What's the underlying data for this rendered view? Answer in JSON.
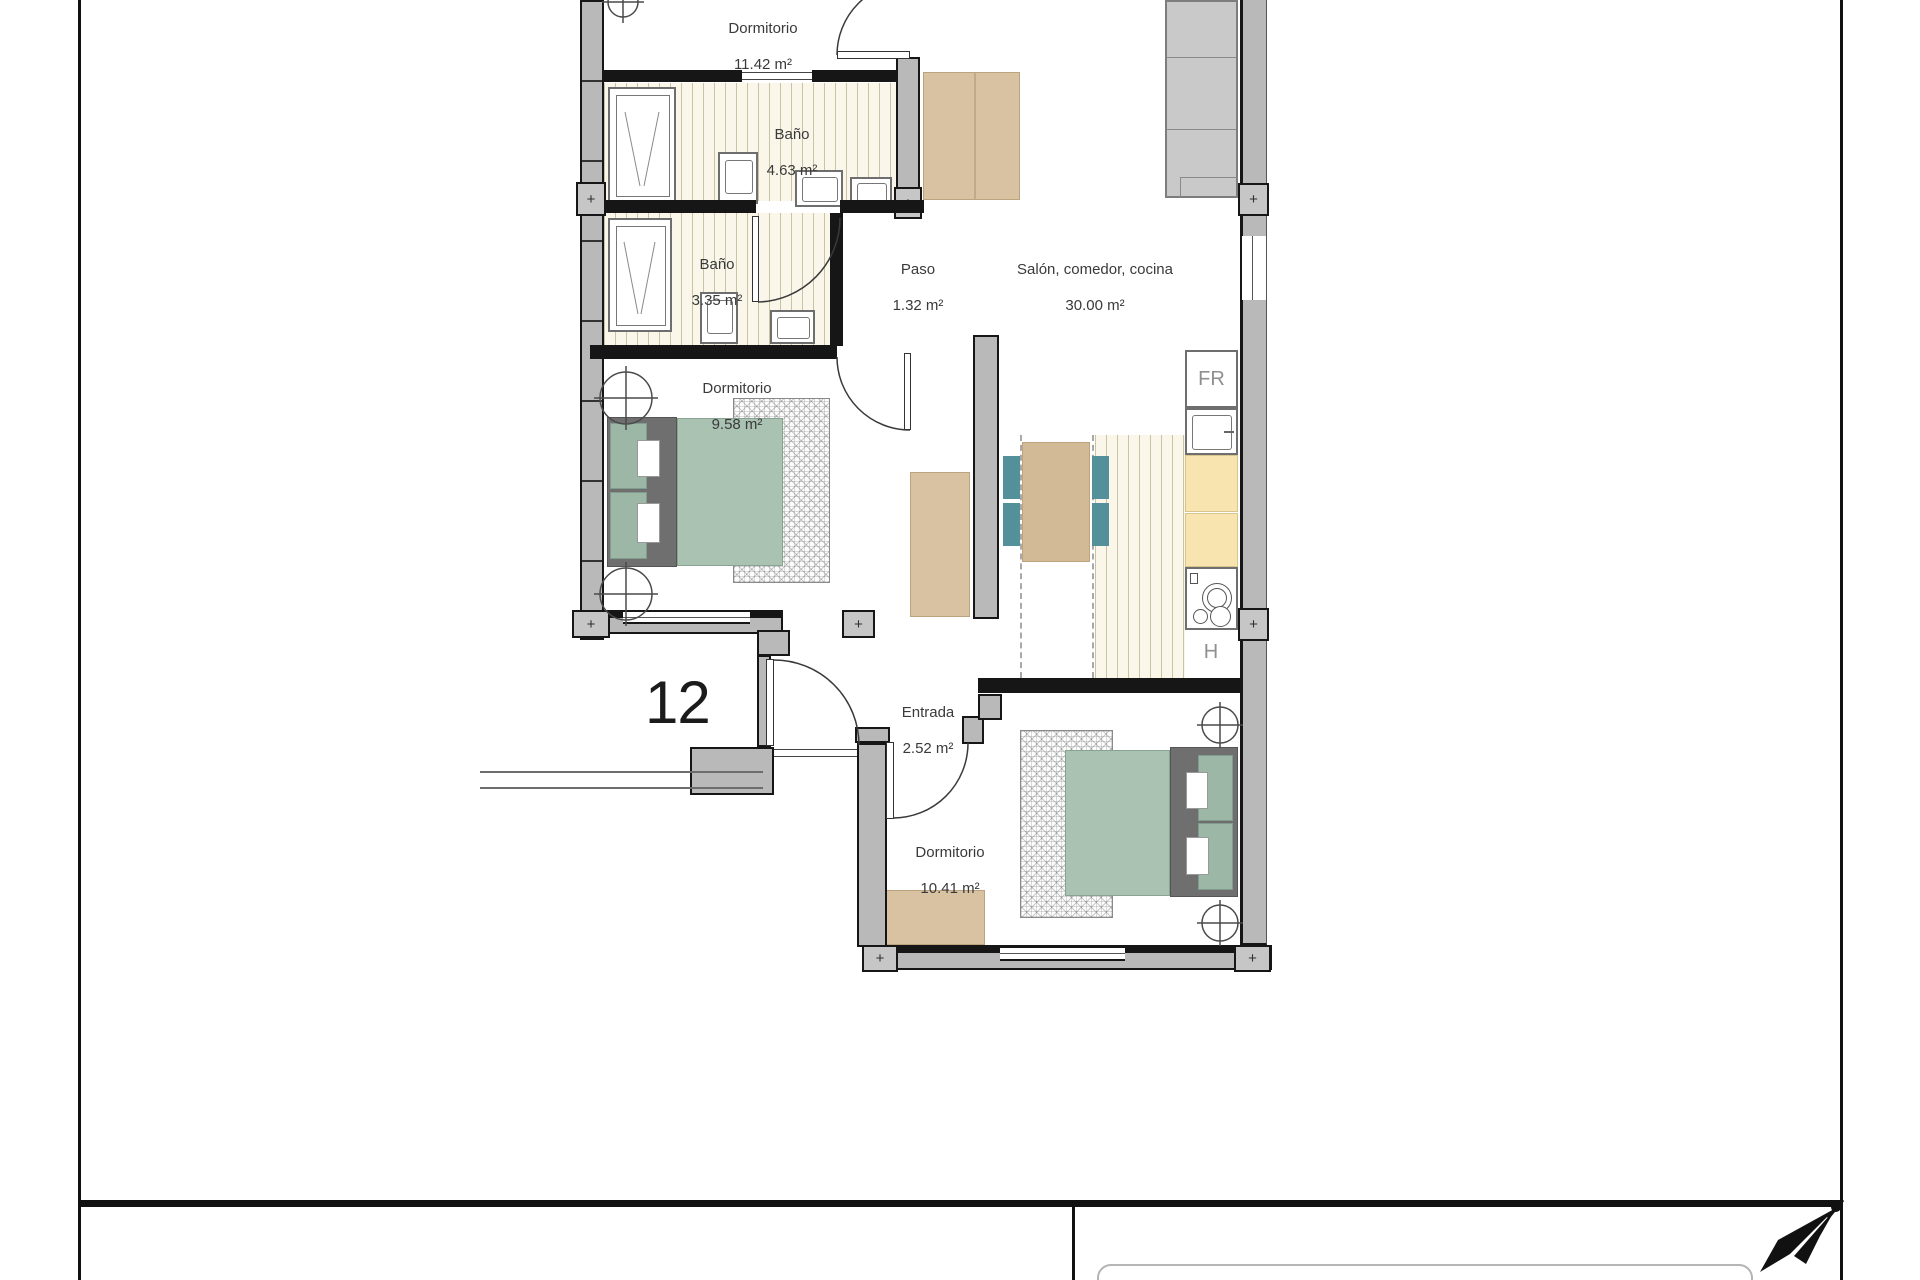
{
  "plan": {
    "unit_number": "12",
    "rooms": [
      {
        "id": "dormitorio-1",
        "name": "Dormitorio",
        "area": "11.42 m²"
      },
      {
        "id": "bano-1",
        "name": "Baño",
        "area": "4.63 m²"
      },
      {
        "id": "bano-2",
        "name": "Baño",
        "area": "3.35 m²"
      },
      {
        "id": "paso",
        "name": "Paso",
        "area": "1.32 m²"
      },
      {
        "id": "salon-comedor-cocina",
        "name": "Salón, comedor, cocina",
        "area": "30.00 m²"
      },
      {
        "id": "dormitorio-2",
        "name": "Dormitorio",
        "area": "9.58 m²"
      },
      {
        "id": "entrada",
        "name": "Entrada",
        "area": "2.52 m²"
      },
      {
        "id": "dormitorio-3",
        "name": "Dormitorio",
        "area": "10.41 m²"
      }
    ],
    "appliances": {
      "fridge_label": "FR",
      "hob_label": "H"
    },
    "markers": {
      "wall_junction": "+"
    }
  },
  "icons": {
    "north_arrow": "north-arrow-icon",
    "ceiling_fixture": "circle-cross-icon",
    "wall_junction": "plus-marker-icon"
  },
  "colors": {
    "wall_gray": "#b9b9b9",
    "line_black": "#161616",
    "floor_stripe_bg": "#faf7ea",
    "floor_stripe_line": "#c9c3a6",
    "bed_green": "#a9c2b2",
    "headboard_gray": "#6f6f6f",
    "furniture_tan": "#d8c2a2",
    "chair_teal": "#54909a",
    "cabinet_yellow": "#f8e4ae",
    "sofa_gray": "#c9c9c9"
  }
}
